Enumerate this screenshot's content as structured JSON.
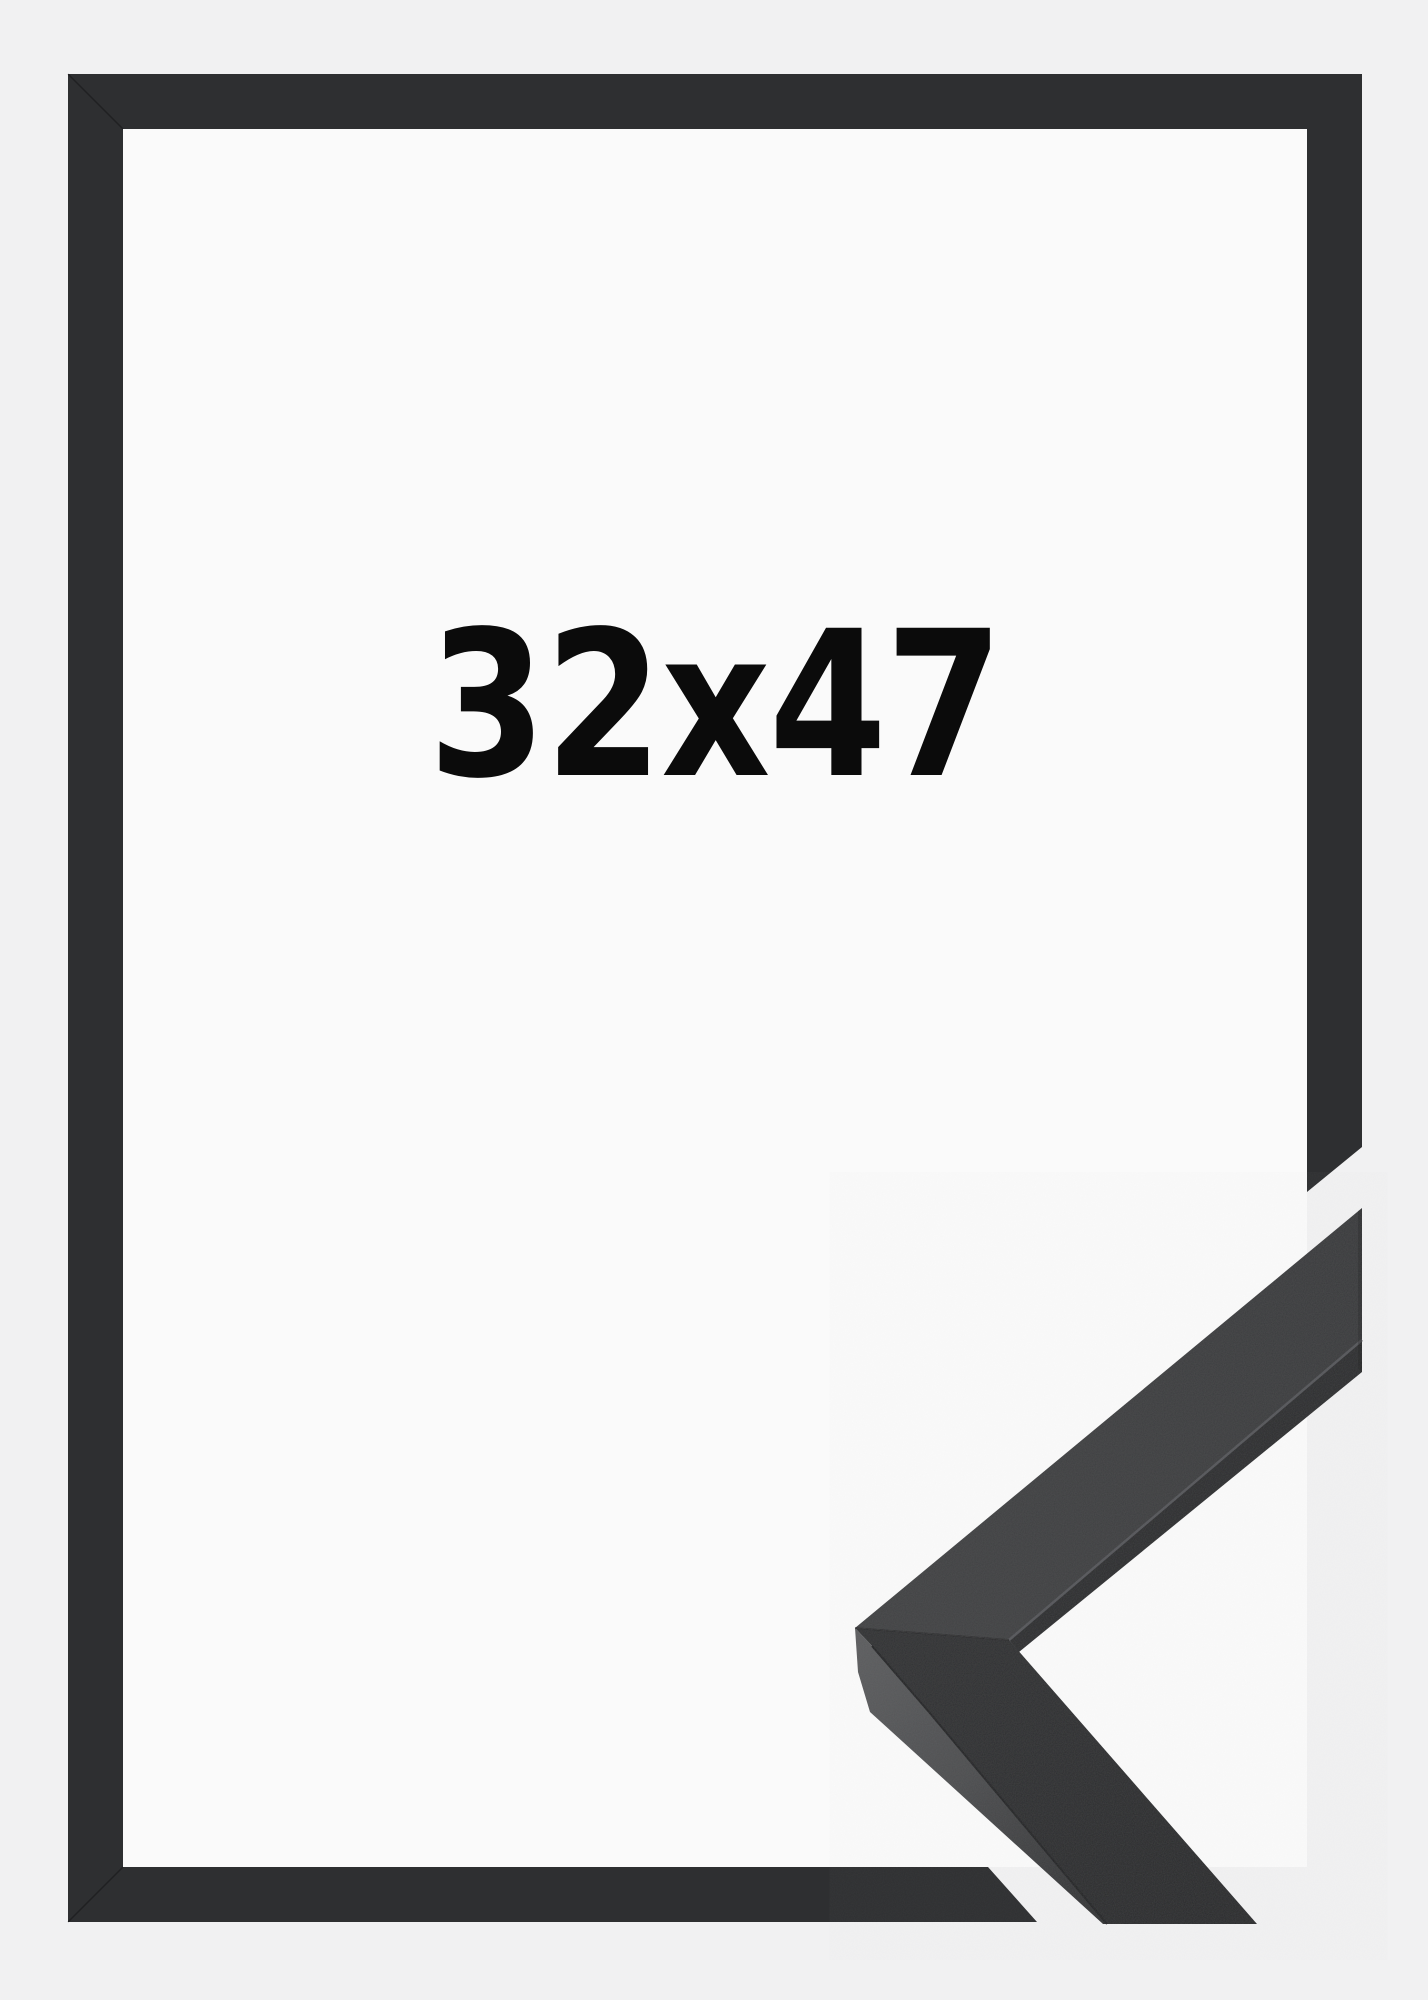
{
  "label": {
    "text": "32x47"
  },
  "colors": {
    "page_background": "#f1f1f2",
    "frame_interior": "#fafafa",
    "frame_molding": "#2e2f31",
    "closeup_top_face": "#3c3d3f",
    "closeup_dark_face": "#2a2b2d",
    "closeup_lit_edge": "#58595b",
    "label_text": "#0b0b0b"
  }
}
